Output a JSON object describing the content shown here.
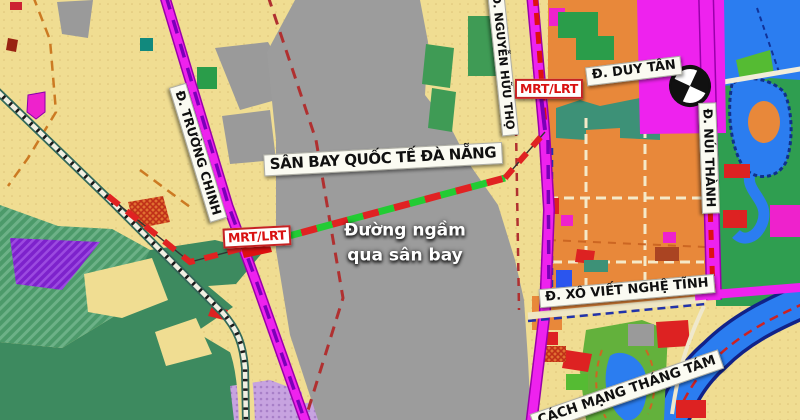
{
  "map": {
    "airport_label": "SÂN BAY QUỐC TẾ ĐÀ NẴNG",
    "tunnel_note": {
      "line1": "Đường ngầm",
      "line2": "qua sân bay"
    },
    "transit_badges": [
      {
        "label": "MRT/LRT"
      },
      {
        "label": "MRT/LRT"
      }
    ],
    "streets": [
      {
        "id": "truong-chinh",
        "label": "Đ. TRƯỜNG CHINH"
      },
      {
        "id": "nguyen-huu-tho",
        "label": "Đ. NGUYỄN HỮU THỌ"
      },
      {
        "id": "duy-tan",
        "label": "Đ. DUY TÂN"
      },
      {
        "id": "nui-thanh",
        "label": "Đ. NÚI THÀNH"
      },
      {
        "id": "xo-viet-nghe-tinh",
        "label": "Đ. XÔ VIẾT NGHỆ TĨNH"
      },
      {
        "id": "cach-mang-thang-tam",
        "label": "CÁCH MẠNG THÁNG TÁM"
      }
    ],
    "symbols": [
      {
        "id": "interchange-circle",
        "meaning": "road interchange symbol"
      }
    ],
    "colors": {
      "land": "#f0dd92",
      "airport_area": "#9c9c9c",
      "main_road_magenta": "#ee22ee",
      "tunnel_dash_red": "#e02222",
      "tunnel_dash_green": "#22cc33",
      "water_blue": "#2b7df0",
      "green_space": "#3d8a5f",
      "district_orange": "#e8883a"
    }
  }
}
